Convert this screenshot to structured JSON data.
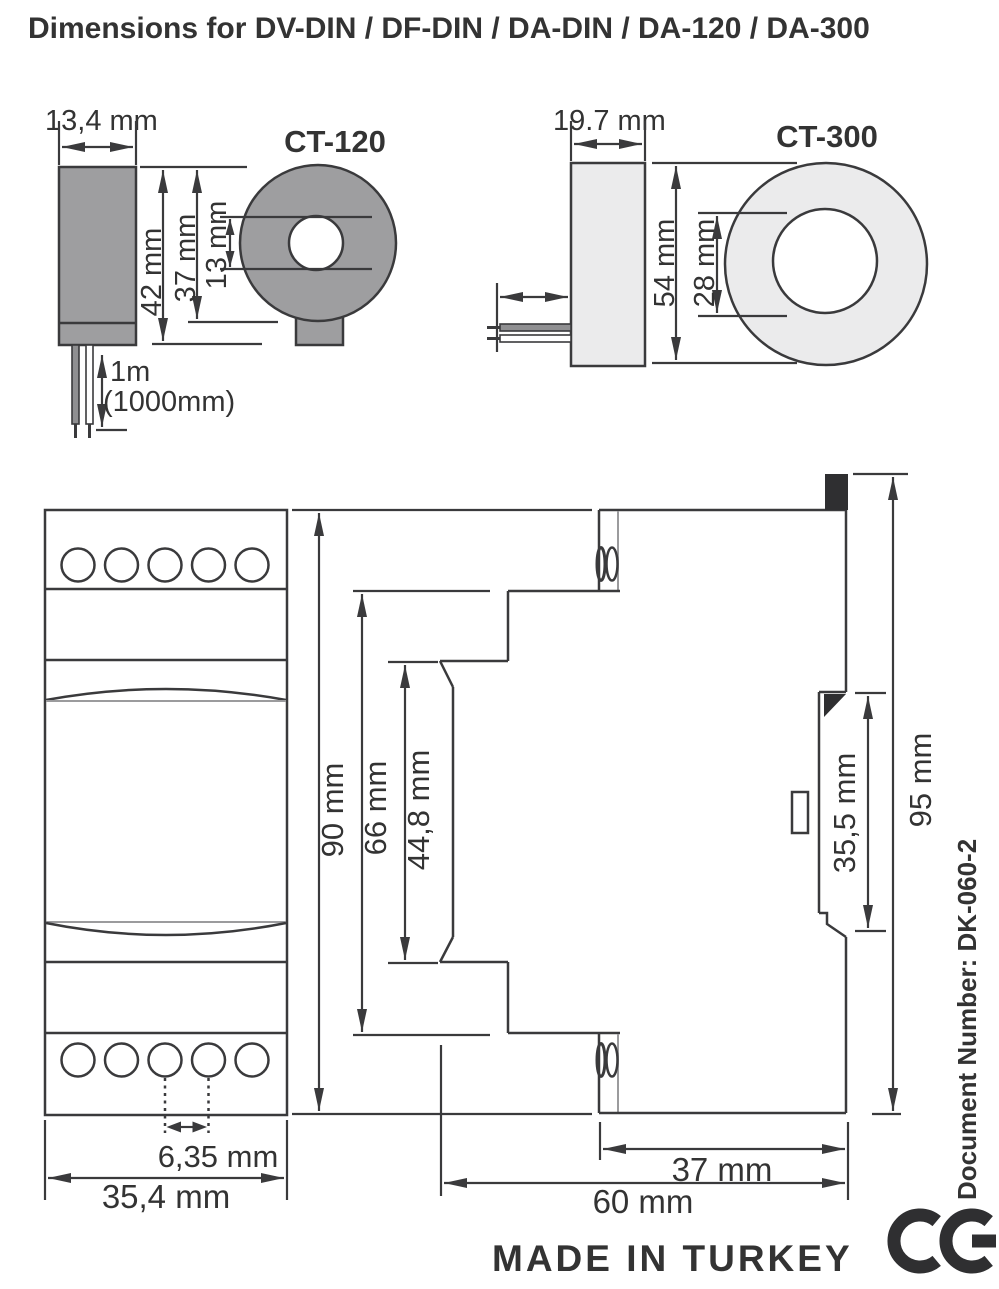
{
  "title": "Dimensions for DV-DIN / DF-DIN / DA-DIN / DA-120 / DA-300",
  "colors": {
    "line": "#3a3a3c",
    "text": "#333333",
    "ct120_fill": "#9e9ea0",
    "ct300_fill": "#ebebec",
    "black_fill": "#2f2f31",
    "gray_line": "#9b9b9d"
  },
  "ct120": {
    "label": "CT-120",
    "width_dim": "13,4 mm",
    "outer_dim": "42 mm",
    "body_dim": "37 mm",
    "hole_dim": "13 mm",
    "cable_length": "1m",
    "cable_length_alt": "(1000mm)"
  },
  "ct300": {
    "label": "CT-300",
    "width_dim": "19.7 mm",
    "outer_dim": "54 mm",
    "hole_dim": "28 mm"
  },
  "module_front": {
    "height_dim": "90 mm",
    "width_dim": "35,4 mm",
    "terminal_pitch_dim": "6,35 mm"
  },
  "module_side": {
    "front_height_dim": "66 mm",
    "window_height_dim": "44,8 mm",
    "rail_slot_dim": "35,5 mm",
    "overall_height_dim": "95 mm",
    "rear_depth_dim": "37 mm",
    "overall_depth_dim": "60 mm"
  },
  "footer": {
    "made_in": "MADE IN TURKEY",
    "ce_mark": "CE"
  },
  "document_number": "Document Number: DK-060-2"
}
